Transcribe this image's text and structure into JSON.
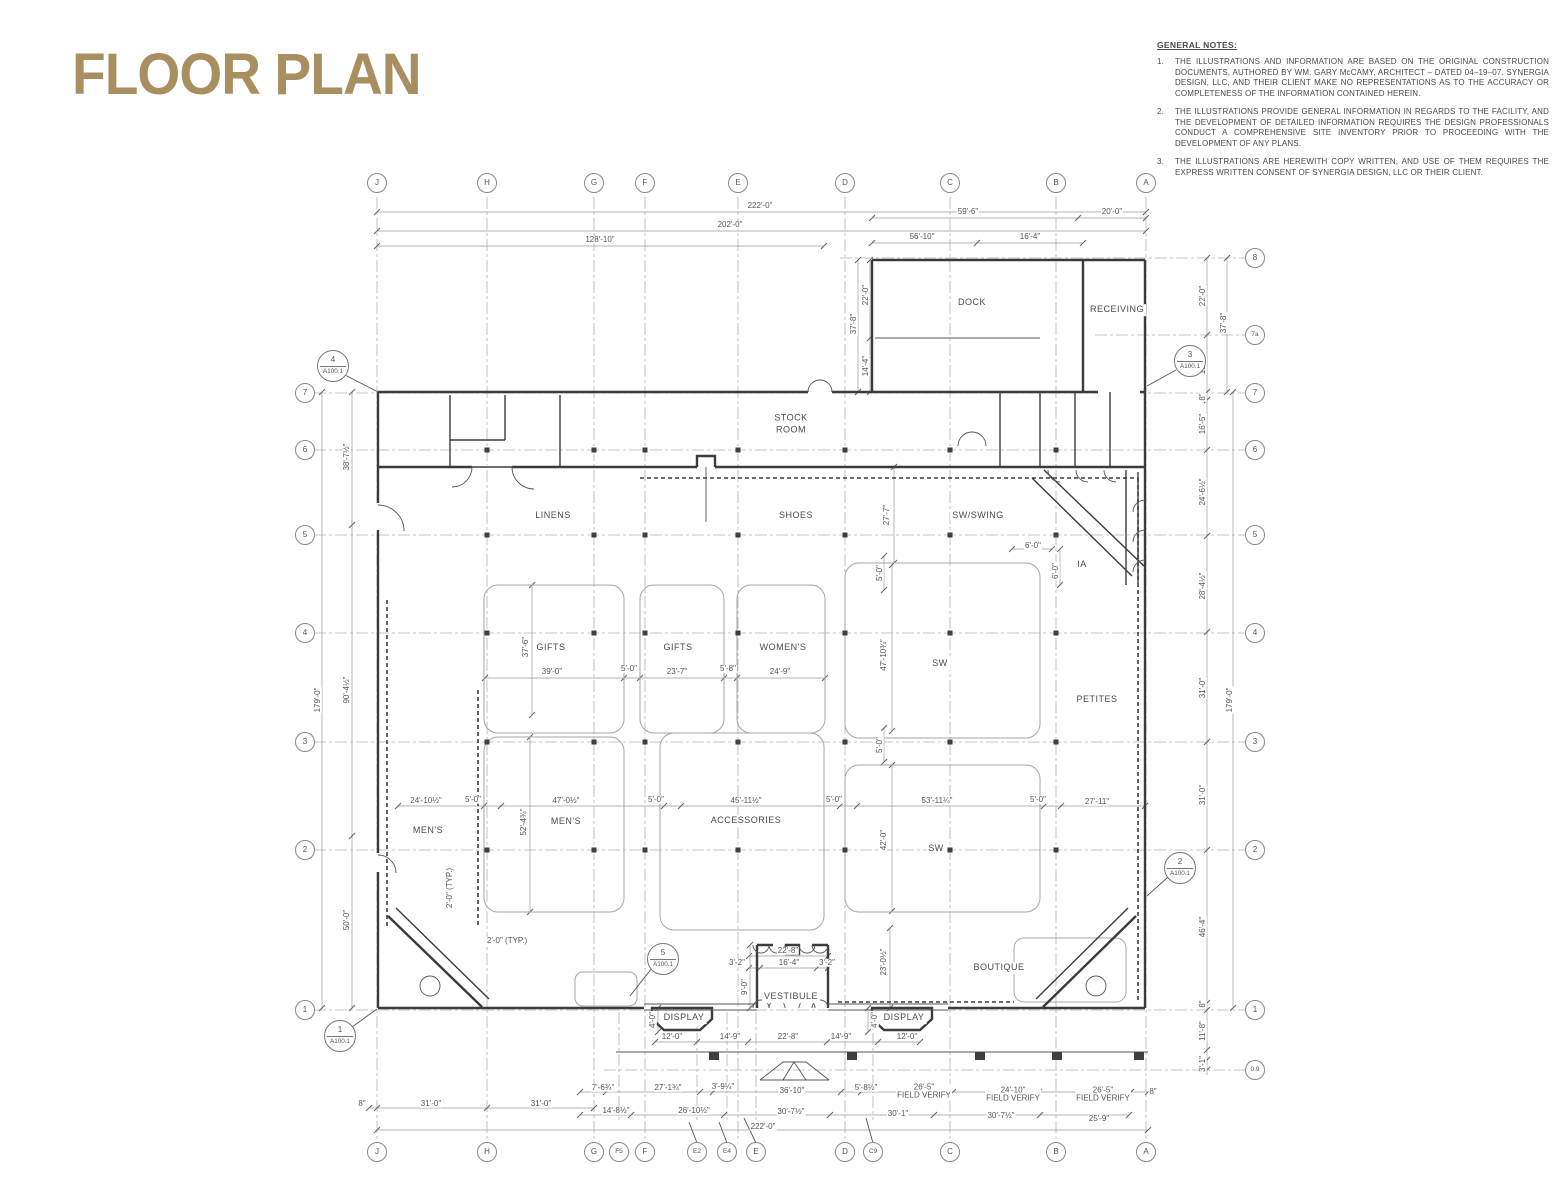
{
  "title": "FLOOR PLAN",
  "sheet": "A100.1",
  "accent_color": "#a98f5f",
  "notes": {
    "heading": "GENERAL NOTES:",
    "items": [
      "THE ILLUSTRATIONS AND INFORMATION ARE BASED ON THE ORIGINAL CONSTRUCTION DOCUMENTS, AUTHORED BY WM. GARY McCAMY, ARCHITECT – DATED 04–19–07. SYNERGIA DESIGN, LLC, AND THEIR CLIENT MAKE NO REPRESENTATIONS AS TO THE ACCURACY OR COMPLETENESS OF THE INFORMATION CONTAINED HEREIN.",
      "THE ILLUSTRATIONS PROVIDE GENERAL INFORMATION IN REGARDS TO THE FACILITY, AND THE DEVELOPMENT OF DETAILED INFORMATION REQUIRES THE DESIGN PROFESSIONALS CONDUCT A COMPREHENSIVE SITE INVENTORY PRIOR TO PROCEEDING WITH THE DEVELOPMENT OF ANY PLANS.",
      "THE ILLUSTRATIONS ARE HEREWITH COPY WRITTEN, AND USE OF THEM REQUIRES THE EXPRESS WRITTEN CONSENT OF SYNERGIA DESIGN, LLC OR THEIR CLIENT."
    ]
  },
  "grid": {
    "cols": [
      {
        "l": "J",
        "x": 377
      },
      {
        "l": "H",
        "x": 487
      },
      {
        "l": "G",
        "x": 594
      },
      {
        "l": "F",
        "x": 645
      },
      {
        "l": "E",
        "x": 738
      },
      {
        "l": "D",
        "x": 845
      },
      {
        "l": "C",
        "x": 950
      },
      {
        "l": "B",
        "x": 1056
      },
      {
        "l": "A",
        "x": 1146
      }
    ],
    "stub_cols": [
      {
        "l": "F5",
        "x": 619
      },
      {
        "l": "E2",
        "x": 697
      },
      {
        "l": "E4",
        "x": 727
      },
      {
        "l": "E",
        "x": 756
      },
      {
        "l": "C9",
        "x": 873
      }
    ],
    "bottom_bubbles": [
      {
        "l": "J",
        "x": 377
      },
      {
        "l": "H",
        "x": 487
      },
      {
        "l": "G",
        "x": 594
      },
      {
        "l": "F5",
        "x": 619
      },
      {
        "l": "F",
        "x": 645
      },
      {
        "l": "E2",
        "x": 697
      },
      {
        "l": "E4",
        "x": 727
      },
      {
        "l": "E",
        "x": 756
      },
      {
        "l": "D",
        "x": 845
      },
      {
        "l": "C9",
        "x": 873
      },
      {
        "l": "C",
        "x": 950
      },
      {
        "l": "B",
        "x": 1056
      },
      {
        "l": "A",
        "x": 1146
      }
    ],
    "rows": [
      {
        "l": "8",
        "y": 258,
        "x1": 840,
        "left": false
      },
      {
        "l": "7a",
        "y": 335,
        "x1": 1095,
        "left": false
      },
      {
        "l": "7",
        "y": 393,
        "left": true
      },
      {
        "l": "6",
        "y": 450,
        "left": true
      },
      {
        "l": "5",
        "y": 535,
        "left": true
      },
      {
        "l": "4",
        "y": 633,
        "left": true
      },
      {
        "l": "3",
        "y": 742,
        "left": true
      },
      {
        "l": "2",
        "y": 850,
        "left": true
      },
      {
        "l": "1",
        "y": 1010,
        "left": true
      },
      {
        "l": "0.9",
        "y": 1070,
        "x1": 604,
        "left": false
      }
    ],
    "bubble_y_top": 183,
    "bubble_y_bottom": 1152,
    "bubble_x_left": 305,
    "bubble_x_right": 1255
  },
  "columns": {
    "cols": [
      487,
      594,
      645,
      738,
      845,
      950,
      1056
    ],
    "rows": [
      450,
      535,
      633,
      742,
      850
    ]
  },
  "canopy_columns": [
    [
      714,
      1056
    ],
    [
      852,
      1056
    ],
    [
      980,
      1056
    ],
    [
      1057,
      1056
    ],
    [
      1139,
      1056
    ]
  ],
  "dimlines_h": [
    {
      "y": 212,
      "x1": 377,
      "x2": 1146,
      "t": [
        377,
        1146
      ]
    },
    {
      "y": 231,
      "x1": 377,
      "x2": 1146,
      "t": [
        377,
        1146
      ]
    },
    {
      "y": 246,
      "x1": 377,
      "x2": 824,
      "t": [
        377,
        824
      ]
    },
    {
      "y": 218,
      "x1": 872,
      "x2": 1146,
      "t": [
        872,
        1078,
        1146
      ]
    },
    {
      "y": 243,
      "x1": 872,
      "x2": 1083,
      "t": [
        872,
        977,
        1083
      ]
    },
    {
      "y": 678,
      "x1": 485,
      "x2": 825,
      "t": [
        485,
        624,
        640,
        724,
        737,
        825
      ]
    },
    {
      "y": 806,
      "x1": 398,
      "x2": 1145,
      "t": [
        398,
        484,
        501,
        664,
        681,
        840,
        857,
        1044,
        1061,
        1145
      ]
    },
    {
      "y": 956,
      "x1": 749,
      "x2": 828,
      "t": [
        749,
        828
      ]
    },
    {
      "y": 968,
      "x1": 749,
      "x2": 828,
      "t": [
        749,
        760,
        817,
        828
      ]
    },
    {
      "y": 1042,
      "x1": 655,
      "x2": 920,
      "t": [
        655,
        697,
        748,
        827,
        878,
        920
      ]
    },
    {
      "y": 1092,
      "x1": 580,
      "x2": 1148,
      "t": [
        580,
        606,
        700,
        713,
        841,
        861,
        953,
        1039,
        1131,
        1148
      ]
    },
    {
      "y": 1115,
      "x1": 580,
      "x2": 1129,
      "t": [
        580,
        631,
        724,
        830,
        934,
        1040,
        1129
      ]
    },
    {
      "y": 1130,
      "x1": 377,
      "x2": 1148,
      "t": [
        377,
        1148
      ]
    },
    {
      "y": 1108,
      "x1": 369,
      "x2": 594,
      "t": [
        369,
        377,
        487,
        594
      ]
    },
    {
      "y": 549,
      "x1": 1012,
      "x2": 1052,
      "t": [
        1012,
        1052
      ]
    }
  ],
  "dimlines_v": [
    {
      "x": 322,
      "y1": 392,
      "y2": 1008,
      "t": [
        392,
        1008
      ]
    },
    {
      "x": 352,
      "y1": 392,
      "y2": 1008,
      "t": [
        392,
        525,
        836,
        1008
      ]
    },
    {
      "x": 858,
      "y1": 260,
      "y2": 392,
      "t": [
        260,
        392
      ]
    },
    {
      "x": 870,
      "y1": 260,
      "y2": 392,
      "t": [
        260,
        338,
        392
      ]
    },
    {
      "x": 1207,
      "y1": 258,
      "y2": 1075,
      "t": [
        258,
        335,
        392,
        400,
        450,
        536,
        632,
        742,
        850,
        1003,
        1010,
        1050,
        1060,
        1070
      ]
    },
    {
      "x": 1227,
      "y1": 258,
      "y2": 392,
      "t": [
        258,
        392
      ]
    },
    {
      "x": 1233,
      "y1": 392,
      "y2": 1008,
      "t": [
        392,
        1008
      ]
    },
    {
      "x": 750,
      "y1": 945,
      "y2": 1008,
      "t": [
        945,
        1008
      ]
    },
    {
      "x": 530,
      "y1": 737,
      "y2": 912,
      "t": [
        737,
        912
      ]
    },
    {
      "x": 532,
      "y1": 585,
      "y2": 715,
      "t": [
        585,
        715
      ]
    },
    {
      "x": 892,
      "y1": 565,
      "y2": 731,
      "t": [
        565,
        731
      ]
    },
    {
      "x": 892,
      "y1": 765,
      "y2": 911,
      "t": [
        765,
        911
      ]
    },
    {
      "x": 894,
      "y1": 467,
      "y2": 563,
      "t": [
        467,
        563
      ]
    },
    {
      "x": 890,
      "y1": 928,
      "y2": 1008,
      "t": [
        928,
        1008
      ]
    },
    {
      "x": 884,
      "y1": 556,
      "y2": 590,
      "t": [
        556,
        590
      ]
    },
    {
      "x": 884,
      "y1": 728,
      "y2": 762,
      "t": [
        728,
        762
      ]
    },
    {
      "x": 1060,
      "y1": 549,
      "y2": 585,
      "t": [
        549,
        585
      ]
    },
    {
      "x": 658,
      "y1": 1008,
      "y2": 1032,
      "t": [
        1008,
        1032
      ]
    },
    {
      "x": 868,
      "y1": 1008,
      "y2": 1032,
      "t": [
        1008,
        1032
      ]
    }
  ],
  "dims": [
    {
      "t": "222'-0\"",
      "x": 760,
      "y": 206
    },
    {
      "t": "202'-0\"",
      "x": 730,
      "y": 225
    },
    {
      "t": "128'-10\"",
      "x": 600,
      "y": 240
    },
    {
      "t": "59'-6\"",
      "x": 968,
      "y": 212
    },
    {
      "t": "20'-0\"",
      "x": 1112,
      "y": 212
    },
    {
      "t": "56'-10\"",
      "x": 922,
      "y": 237
    },
    {
      "t": "16'-4\"",
      "x": 1030,
      "y": 237
    },
    {
      "t": "37'-8\"",
      "x": 854,
      "y": 324,
      "r": 1
    },
    {
      "t": "22'-0\"",
      "x": 866,
      "y": 295,
      "r": 1
    },
    {
      "t": "14'-4\"",
      "x": 866,
      "y": 366,
      "r": 1
    },
    {
      "t": "22'-0\"",
      "x": 1203,
      "y": 296,
      "r": 1
    },
    {
      "t": "37'-8\"",
      "x": 1224,
      "y": 323,
      "r": 1
    },
    {
      "t": "15'-8\"",
      "x": 1203,
      "y": 364,
      "r": 1
    },
    {
      "t": "8\"",
      "x": 1203,
      "y": 397,
      "r": 1
    },
    {
      "t": "16'-5\"",
      "x": 1203,
      "y": 424,
      "r": 1
    },
    {
      "t": "24'-6½\"",
      "x": 1203,
      "y": 492,
      "r": 1
    },
    {
      "t": "28'-4½\"",
      "x": 1203,
      "y": 586,
      "r": 1
    },
    {
      "t": "31'-0\"",
      "x": 1203,
      "y": 688,
      "r": 1
    },
    {
      "t": "179'-0\"",
      "x": 1230,
      "y": 700,
      "r": 1
    },
    {
      "t": "31'-0\"",
      "x": 1203,
      "y": 795,
      "r": 1
    },
    {
      "t": "46'-4\"",
      "x": 1203,
      "y": 927,
      "r": 1
    },
    {
      "t": "8\"",
      "x": 1203,
      "y": 1004,
      "r": 1
    },
    {
      "t": "11'-8\"",
      "x": 1203,
      "y": 1031,
      "r": 1
    },
    {
      "t": "3'-1\"",
      "x": 1203,
      "y": 1064,
      "r": 1
    },
    {
      "t": "179'-0\"",
      "x": 318,
      "y": 700,
      "r": 1
    },
    {
      "t": "38'-7½\"",
      "x": 347,
      "y": 457,
      "r": 1
    },
    {
      "t": "90'-4½\"",
      "x": 347,
      "y": 690,
      "r": 1
    },
    {
      "t": "50'-0\"",
      "x": 347,
      "y": 920,
      "r": 1
    },
    {
      "t": "37'-6\"",
      "x": 526,
      "y": 647,
      "r": 1
    },
    {
      "t": "39'-0\"",
      "x": 552,
      "y": 672
    },
    {
      "t": "5'-0\"",
      "x": 629,
      "y": 669
    },
    {
      "t": "23'-7\"",
      "x": 677,
      "y": 672
    },
    {
      "t": "5'-8\"",
      "x": 728,
      "y": 669
    },
    {
      "t": "24'-9\"",
      "x": 780,
      "y": 672
    },
    {
      "t": "47'-10¾\"",
      "x": 884,
      "y": 655,
      "r": 1
    },
    {
      "t": "27'-7\"",
      "x": 887,
      "y": 515,
      "r": 1
    },
    {
      "t": "5'-0\"",
      "x": 880,
      "y": 573,
      "r": 1
    },
    {
      "t": "5'-0\"",
      "x": 880,
      "y": 745,
      "r": 1
    },
    {
      "t": "6'-0\"",
      "x": 1033,
      "y": 546
    },
    {
      "t": "6'-0\"",
      "x": 1056,
      "y": 571,
      "r": 1
    },
    {
      "t": "24'-10½\"",
      "x": 426,
      "y": 801
    },
    {
      "t": "5'-0\"",
      "x": 473,
      "y": 800
    },
    {
      "t": "47'-0½\"",
      "x": 566,
      "y": 801
    },
    {
      "t": "5'-0\"",
      "x": 656,
      "y": 800
    },
    {
      "t": "45'-11½\"",
      "x": 746,
      "y": 801
    },
    {
      "t": "5'-0\"",
      "x": 834,
      "y": 800
    },
    {
      "t": "53'-11¼\"",
      "x": 937,
      "y": 801
    },
    {
      "t": "5'-0\"",
      "x": 1038,
      "y": 800
    },
    {
      "t": "27'-11\"",
      "x": 1097,
      "y": 802
    },
    {
      "t": "52'-4¾\"",
      "x": 524,
      "y": 822,
      "r": 1
    },
    {
      "t": "42'-0\"",
      "x": 884,
      "y": 840,
      "r": 1
    },
    {
      "t": "2'-0\" (TYP.)",
      "x": 450,
      "y": 888,
      "r": 1
    },
    {
      "t": "2'-0\" (TYP.)",
      "x": 507,
      "y": 941
    },
    {
      "t": "23'-0½\"",
      "x": 884,
      "y": 962,
      "r": 1
    },
    {
      "t": "22'-8\"",
      "x": 788,
      "y": 951
    },
    {
      "t": "3'-2\"",
      "x": 737,
      "y": 963
    },
    {
      "t": "16'-4\"",
      "x": 789,
      "y": 963
    },
    {
      "t": "3'-2\"",
      "x": 827,
      "y": 963
    },
    {
      "t": "9'-0\"",
      "x": 745,
      "y": 987,
      "r": 1
    },
    {
      "t": "4'-0\"",
      "x": 653,
      "y": 1020,
      "r": 1
    },
    {
      "t": "4'-0\"",
      "x": 875,
      "y": 1020,
      "r": 1
    },
    {
      "t": "12'-0\"",
      "x": 672,
      "y": 1037
    },
    {
      "t": "14'-9\"",
      "x": 730,
      "y": 1037
    },
    {
      "t": "22'-8\"",
      "x": 788,
      "y": 1037
    },
    {
      "t": "14'-9\"",
      "x": 841,
      "y": 1037
    },
    {
      "t": "12'-0\"",
      "x": 907,
      "y": 1037
    },
    {
      "t": "8\"",
      "x": 362,
      "y": 1104
    },
    {
      "t": "31'-0\"",
      "x": 431,
      "y": 1104
    },
    {
      "t": "31'-0\"",
      "x": 541,
      "y": 1104
    },
    {
      "t": "7'-6¾\"",
      "x": 603,
      "y": 1088
    },
    {
      "t": "27'-1¾\"",
      "x": 668,
      "y": 1088
    },
    {
      "t": "3'-9¼\"",
      "x": 723,
      "y": 1087
    },
    {
      "t": "36'-10\"",
      "x": 792,
      "y": 1091
    },
    {
      "t": "5'-8½\"",
      "x": 866,
      "y": 1088
    },
    {
      "t": "26'-5\"",
      "x": 924,
      "y": 1092,
      "sub": "FIELD VERIFY"
    },
    {
      "t": "24'-10\"",
      "x": 1013,
      "y": 1095,
      "sub": "FIELD VERIFY"
    },
    {
      "t": "26'-5\"",
      "x": 1103,
      "y": 1095,
      "sub": "FIELD VERIFY"
    },
    {
      "t": "8\"",
      "x": 1153,
      "y": 1092
    },
    {
      "t": "14'-8½\"",
      "x": 616,
      "y": 1111
    },
    {
      "t": "26'-10½\"",
      "x": 694,
      "y": 1111
    },
    {
      "t": "30'-7½\"",
      "x": 791,
      "y": 1112
    },
    {
      "t": "30'-1\"",
      "x": 898,
      "y": 1114
    },
    {
      "t": "30'-7½\"",
      "x": 1001,
      "y": 1116
    },
    {
      "t": "25'-9\"",
      "x": 1099,
      "y": 1119
    },
    {
      "t": "222'-0\"",
      "x": 763,
      "y": 1127
    }
  ],
  "rooms": [
    {
      "label": "DOCK",
      "x": 972,
      "y": 303
    },
    {
      "label": "RECEIVING",
      "x": 1117,
      "y": 310
    },
    {
      "label": "STOCK\nROOM",
      "x": 791,
      "y": 424
    },
    {
      "label": "LINENS",
      "x": 553,
      "y": 516
    },
    {
      "label": "SHOES",
      "x": 796,
      "y": 516
    },
    {
      "label": "SW/SWING",
      "x": 978,
      "y": 516
    },
    {
      "label": "IA",
      "x": 1082,
      "y": 565
    },
    {
      "label": "GIFTS",
      "x": 551,
      "y": 648
    },
    {
      "label": "GIFTS",
      "x": 678,
      "y": 648
    },
    {
      "label": "WOMEN'S",
      "x": 783,
      "y": 648
    },
    {
      "label": "SW",
      "x": 940,
      "y": 664
    },
    {
      "label": "PETITES",
      "x": 1097,
      "y": 700
    },
    {
      "label": "MEN'S",
      "x": 428,
      "y": 831
    },
    {
      "label": "MEN'S",
      "x": 566,
      "y": 822
    },
    {
      "label": "ACCESSORIES",
      "x": 746,
      "y": 821
    },
    {
      "label": "SW",
      "x": 936,
      "y": 849
    },
    {
      "label": "BOUTIQUE",
      "x": 999,
      "y": 968
    },
    {
      "label": "VESTIBULE",
      "x": 791,
      "y": 997
    },
    {
      "label": "DISPLAY",
      "x": 684,
      "y": 1018
    },
    {
      "label": "DISPLAY",
      "x": 904,
      "y": 1018
    }
  ],
  "callouts": [
    {
      "n": "4",
      "x": 333,
      "y": 366
    },
    {
      "n": "3",
      "x": 1190,
      "y": 361
    },
    {
      "n": "5",
      "x": 663,
      "y": 959
    },
    {
      "n": "2",
      "x": 1180,
      "y": 868
    },
    {
      "n": "1",
      "x": 340,
      "y": 1036
    }
  ]
}
